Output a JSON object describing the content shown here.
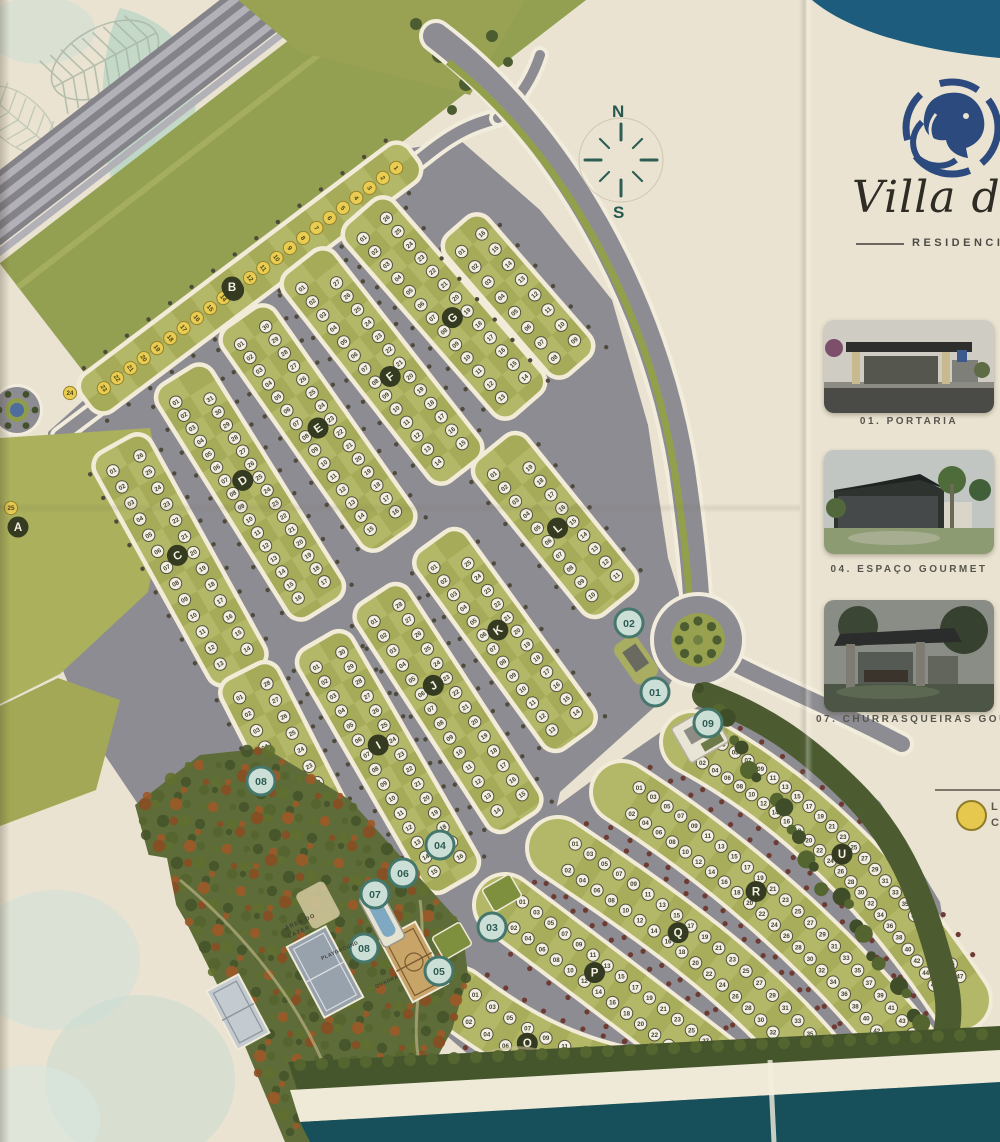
{
  "brand": {
    "logo_icon": "lion-icon",
    "name_script": "Villa de",
    "subtitle": "RESIDENCI"
  },
  "compass": {
    "north": "N",
    "south": "S"
  },
  "sidebar": {
    "cards": [
      {
        "label": "01. PORTARIA"
      },
      {
        "label": "04. ESPAÇO GOURMET"
      },
      {
        "label": "07. CHURRASQUEIRAS GOURMET"
      }
    ]
  },
  "legend": {
    "swatch_color": "#e7c84e",
    "lines": [
      "L",
      "C"
    ]
  },
  "map": {
    "area_labels": {
      "lazer1": "ÁREA DO",
      "lazer2": "LAZER",
      "playground": "PLAYGROUND",
      "quadra": "QUADRA"
    },
    "blocks": [
      {
        "letter": "A"
      },
      {
        "letter": "B",
        "lots": 25,
        "lot_style": "yellow"
      },
      {
        "letter": "C",
        "lots": 26
      },
      {
        "letter": "D",
        "lots": 31
      },
      {
        "letter": "E",
        "lots": 30
      },
      {
        "letter": "F",
        "lots": 27
      },
      {
        "letter": "G",
        "lots": 26
      },
      {
        "letter": "H",
        "lots": 28
      },
      {
        "letter": "I",
        "lots": 30
      },
      {
        "letter": "J",
        "lots": 28
      },
      {
        "letter": "K",
        "lots": 25
      },
      {
        "letter": "L",
        "lots": 19
      },
      {
        "letter": "O",
        "lots": 16
      },
      {
        "letter": "P",
        "lots": 30
      },
      {
        "letter": "Q",
        "lots": 38
      },
      {
        "letter": "R",
        "lots": 46
      },
      {
        "letter": "U",
        "lots": 48
      }
    ],
    "markers": [
      "01",
      "02",
      "03",
      "04",
      "05",
      "06",
      "07",
      "08",
      "09"
    ]
  },
  "colors": {
    "paper": "#eae3d1",
    "teal_band_top": "#1d5c7d",
    "teal_band_bottom": "#17505a",
    "road": "#8d8c92",
    "block_light": "#b3b868",
    "block_dark": "#99a04b",
    "verge_green": "#94a051",
    "lot_yellow": "#e8cd52",
    "marker_fill": "#cbdfd7",
    "marker_ring": "#45776c",
    "badge": "#343b21",
    "wood": "#5d6c38",
    "logo_navy": "#2c4a7d"
  }
}
